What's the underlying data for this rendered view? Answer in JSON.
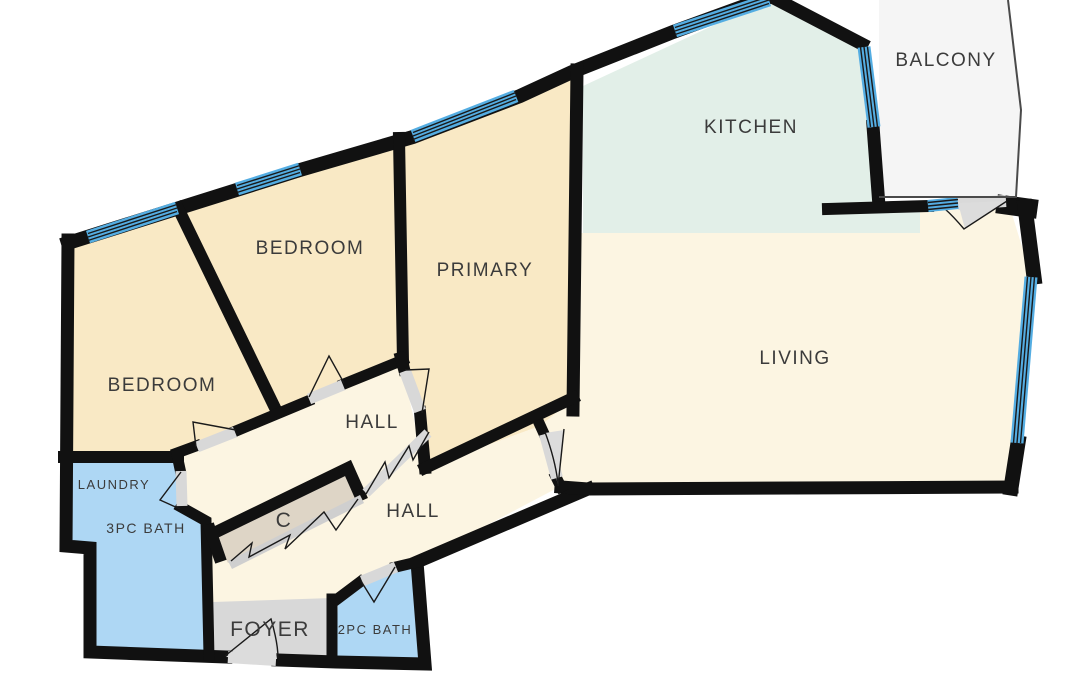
{
  "floorplan": {
    "title": "apartment-floor-plan",
    "rooms": {
      "balcony": {
        "label": "BALCONY"
      },
      "kitchen": {
        "label": "KITCHEN"
      },
      "living": {
        "label": "LIVING"
      },
      "primary": {
        "label": "PRIMARY"
      },
      "bedroom_mid": {
        "label": "BEDROOM"
      },
      "bedroom_left": {
        "label": "BEDROOM"
      },
      "hall_upper": {
        "label": "HALL"
      },
      "hall_lower": {
        "label": "HALL"
      },
      "laundry": {
        "label": "LAUNDRY"
      },
      "bath_3pc": {
        "label": "3PC BATH"
      },
      "closet": {
        "label": "C"
      },
      "foyer": {
        "label": "FOYER"
      },
      "bath_2pc": {
        "label": "2PC BATH"
      }
    },
    "colors": {
      "wall": "#111111",
      "bedroom_fill": "#f9e9c5",
      "kitchen_fill": "#e2efe8",
      "living_fill": "#fcf5e2",
      "bath_fill": "#aed7f4",
      "closet_fill": "#ded5c6",
      "foyer_fill": "#d8d8d8",
      "balcony_fill": "#f5f5f5",
      "window_blue": "#54ade2",
      "threshold_gray": "#d8d8d8",
      "swing_gray": "#dcdcdc",
      "label_text": "#3b3b3b"
    }
  }
}
